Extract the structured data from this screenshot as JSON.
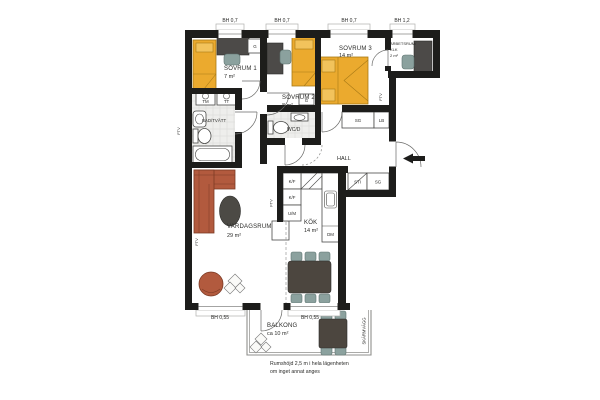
{
  "plan": {
    "windows_top": [
      "BH 0,7",
      "BH 0,7",
      "BH 0,7",
      "BH 1,2"
    ],
    "windows_bottom": [
      "BH 0,55",
      "BH 0,55"
    ],
    "rooms": {
      "sovrum1": {
        "name": "SOVRUM 1",
        "area": "7 m²"
      },
      "sovrum2": {
        "name": "SOVRUM 2",
        "area": "8 m²"
      },
      "sovrum3": {
        "name": "SOVRUM 3",
        "area": "14 m²"
      },
      "arbetsrum": {
        "line1": "ARBETSRUM/",
        "line2": "KLK",
        "area": "2 m²"
      },
      "bad": {
        "name": "BAD/TVÄTT"
      },
      "wcd": {
        "name": "WC/D"
      },
      "hall": {
        "name": "HALL"
      },
      "kok": {
        "name": "KÖK",
        "area": "14 m²"
      },
      "vardagsrum": {
        "name": "VARDAGSRUM",
        "area": "29 m²"
      },
      "balkong": {
        "name": "BALKONG",
        "area": "ca 10 m²"
      }
    },
    "closets": {
      "g1": "G",
      "g2": "G",
      "sg1": "SG",
      "lb": "LB",
      "sti": "STI",
      "sg2": "SG"
    },
    "appliances": {
      "tm": "TM",
      "tt": "TT",
      "kf1": "K/F",
      "kf2": "K/F",
      "um": "U/M",
      "dm": "DM"
    },
    "vents": [
      "FTV",
      "FTV",
      "FTV",
      "FTV"
    ],
    "screen_wall": "SKÄRMVÄGG",
    "note": {
      "line1": "Rumshöjd 2,5 m i hela lägenheten",
      "line2": "om inget annat anges"
    },
    "colors": {
      "wall": "#1d1d1b",
      "bed": "#ebaa2e",
      "pillow": "#f2c35c",
      "sofa": "#b25a3e",
      "dark_furniture": "#4c4a45",
      "chair": "#8ba19e",
      "tile": "#eeeeec"
    }
  }
}
